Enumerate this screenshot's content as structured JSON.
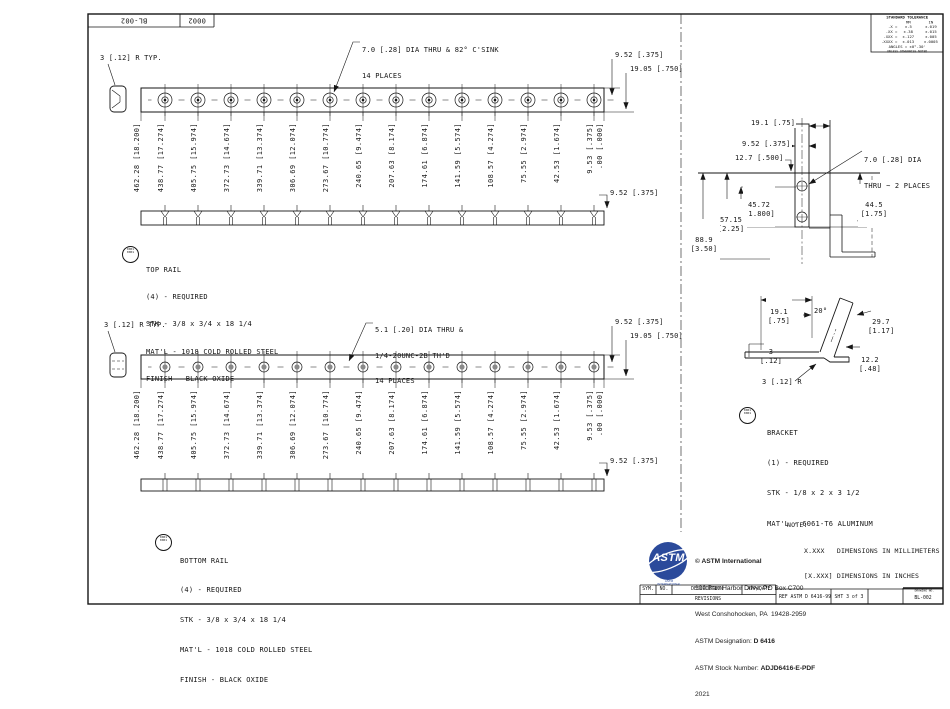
{
  "sheet": {
    "corner": {
      "drawing_no": "BL-002",
      "zone": "0002"
    },
    "tolerance": {
      "title": "STANDARD TOLERANCE",
      "col_mm": "MM",
      "col_in": "IN",
      "rows": [
        {
          "p": ".X =",
          "mm": "±.5",
          "inch": "±.019"
        },
        {
          "p": ".XX =",
          "mm": "±.38",
          "inch": "±.015"
        },
        {
          "p": ".XXX =",
          "mm": "±.127",
          "inch": "±.005"
        },
        {
          "p": ".XXXX =",
          "mm": "±.013",
          "inch": "±.0005"
        }
      ],
      "angles": "ANGLES = ±0°-30'",
      "note": "UNLESS OTHERWISE NOTED"
    },
    "line_color": "#161616",
    "logo_blue": "#2b4a9b"
  },
  "top_rail": {
    "radius_note": "3 [.12] R TYP.",
    "hole_note": [
      "7.0 [.28] DIA THRU & 82° C'SINK",
      "14 PLACES"
    ],
    "dim_offset": "9.52 [.375]",
    "dim_width": "19.05 [.750]",
    "dim_side": "9.52 [.375]",
    "ordinates": [
      "462.28 [18.200]",
      "438.77 [17.274]",
      "405.75 [15.974]",
      "372.73 [14.674]",
      "339.71 [13.374]",
      "306.69 [12.074]",
      "273.67 [10.774]",
      "240.65 [9.474]",
      "207.63 [8.174]",
      "174.61 [6.874]",
      "141.59 [5.574]",
      "108.57 [4.274]",
      "75.55 [2.974]",
      "42.53 [1.674]",
      "9.53 [.375]",
      ".00 [.000]"
    ],
    "balloon": [
      "0001",
      "0001"
    ],
    "name": "TOP RAIL",
    "spec": [
      "(4) - REQUIRED",
      "STK - 3/8 x 3/4 x 18 1/4",
      "MAT'L - 1018 COLD ROLLED STEEL",
      "FINISH - BLACK OXIDE"
    ]
  },
  "bottom_rail": {
    "radius_note": "3 [.12] R TYP.",
    "hole_note": [
      "5.1 [.20] DIA THRU &",
      "1/4-20UNC-2B TH'D",
      "14 PLACES"
    ],
    "dim_offset": "9.52 [.375]",
    "dim_width": "19.05 [.750]",
    "dim_side": "9.52 [.375]",
    "ordinates": [
      "462.28 [18.200]",
      "438.77 [17.274]",
      "405.75 [15.974]",
      "372.73 [14.674]",
      "339.71 [13.374]",
      "306.69 [12.074]",
      "273.67 [10.774]",
      "240.65 [9.474]",
      "207.63 [8.174]",
      "174.61 [6.874]",
      "141.59 [5.574]",
      "108.57 [4.274]",
      "75.55 [2.974]",
      "42.53 [1.674]",
      "9.53 [.375]",
      ".00 [.000]"
    ],
    "balloon": [
      "0001",
      "0001"
    ],
    "name": "BOTTOM RAIL",
    "spec": [
      "(4) - REQUIRED",
      "STK - 3/8 x 3/4 x 18 1/4",
      "MAT'L - 1018 COLD ROLLED STEEL",
      "FINISH - BLACK OXIDE"
    ]
  },
  "bracket": {
    "front_view": {
      "d1": "19.1 [.75]",
      "d2": "9.52 [.375]",
      "d3": "12.7 [.500]",
      "d4a": "45.72",
      "d4b": "[1.800]",
      "d5a": "57.15",
      "d5b": "[2.25]",
      "d6a": "88.9",
      "d6b": "[3.50]",
      "d7a": "44.5",
      "d7b": "[1.75]",
      "hole_note": [
        "7.0 [.28] DIA",
        "THRU ~ 2 PLACES"
      ]
    },
    "side_view": {
      "d1a": "19.1",
      "d1b": "[.75]",
      "angle": "20°",
      "d2a": "29.7",
      "d2b": "[1.17]",
      "d3a": "3",
      "d3b": "[.12]",
      "d4a": "12.2",
      "d4b": "[.48]",
      "radius_note": "3 [.12] R"
    },
    "balloon": [
      "0001",
      "0001"
    ],
    "name": "BRACKET",
    "spec": [
      "(1) - REQUIRED",
      "STK - 1/8 x 2 x 3 1/2",
      "MAT'L - 6061-T6 ALUMINUM"
    ]
  },
  "units_note": {
    "title": "NOTE:",
    "line1": "X.XXX   DIMENSIONS IN MILLIMETERS",
    "line2": "[X.XXX] DIMENSIONS IN INCHES"
  },
  "astm": {
    "logo": "ASTM",
    "logo_caption": "ASTM INTERNATIONAL",
    "copyright": "© ASTM International",
    "address1": "100 Barr Harbor Drive, PO Box C700",
    "address2": "West Conshohocken, PA  19428-2959",
    "designation_label": "ASTM Designation:",
    "designation": "D 6416",
    "stock_label": "ASTM Stock Number:",
    "stock": "ADJD6416-E-PDF",
    "year": "2021"
  },
  "title_block": {
    "sym": "SYM.",
    "no": "NO.",
    "description": "DESCRIPTION",
    "app_date": "APP/DATE",
    "revisions": "REVISIONS",
    "ref": "REF ASTM D 6416-99",
    "sheet": "SHT 3 of 3",
    "drawing_no_label": "DRAWING NO.",
    "drawing_no": "BL-002"
  }
}
